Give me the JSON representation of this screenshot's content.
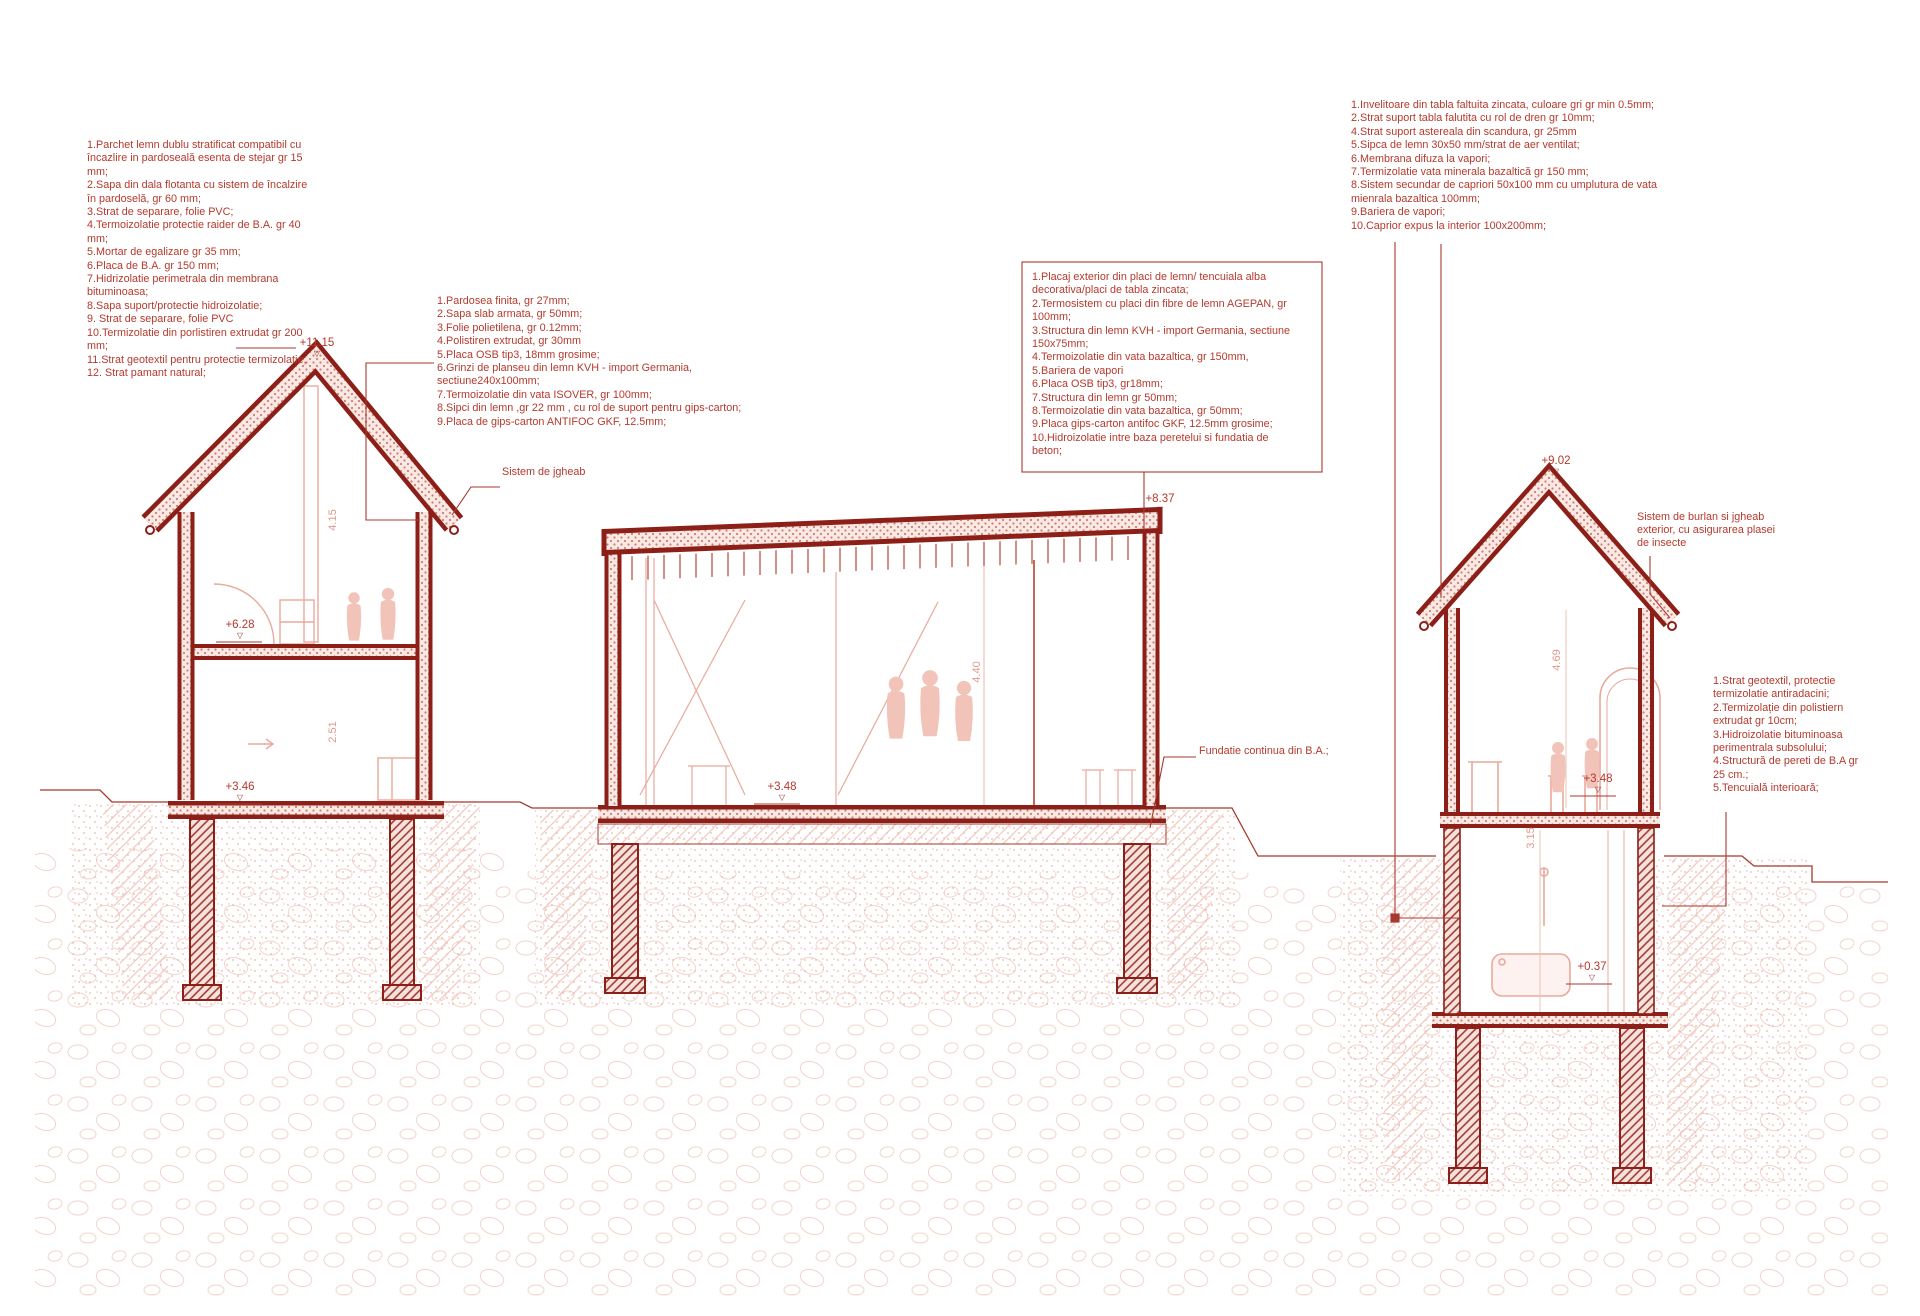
{
  "palette": {
    "structure_dark": "#8c1f17",
    "line_medium": "#a8382d",
    "annotation_red": "#b43a2e",
    "interior_pink": "#e9a99c",
    "soil_pink": "#f2d4cc"
  },
  "annotations": {
    "ground_floor_buildup": {
      "items": [
        "1.Parchet lemn dublu stratificat compatibil cu încazlire in pardoseală esenta de stejar gr 15 mm;",
        "2.Sapa din dala flotanta cu sistem de încalzire în pardoselă, gr 60 mm;",
        "3.Strat de separare, folie PVC;",
        "4.Termoizolatie protectie raider de B.A. gr 40 mm;",
        "5.Mortar de egalizare gr 35 mm;",
        "6.Placa de B.A. gr 150 mm;",
        "7.Hidrizolatie perimetrala din membrana bituminoasa;",
        "8.Sapa suport/protectie hidroizolatie;",
        "9. Strat de separare, folie PVC",
        "10.Termizolatie din porlistiren extrudat gr 200 mm;",
        "11.Strat geotextil pentru protectie termizolatie;",
        "12. Strat pamant natural;"
      ]
    },
    "intermediate_floor_buildup": {
      "items": [
        "1.Pardosea finita, gr 27mm;",
        "2.Sapa slab armata, gr 50mm;",
        "3.Folie polietilena, gr 0.12mm;",
        "4.Polistiren extrudat, gr 30mm",
        "5.Placa OSB tip3, 18mm grosime;",
        "6.Grinzi de planseu din lemn KVH - import Germania, sectiune240x100mm;",
        "7.Termoizolatie din vata ISOVER, gr 100mm;",
        "8.Sipci din lemn ,gr 22 mm , cu rol de suport pentru gips-carton;",
        "9.Placa de gips-carton ANTIFOC GKF, 12.5mm;"
      ]
    },
    "roof_buildup": {
      "items": [
        "1.Invelitoare din tabla faltuita zincata, culoare gri gr min 0.5mm;",
        "2.Strat suport tabla falutita cu rol de dren gr 10mm;",
        "4.Strat suport astereala din scandura, gr 25mm",
        "5.Sipca de lemn 30x50 mm/strat de aer ventilat;",
        "6.Membrana difuza la vapori;",
        "7.Termizolatie vata minerala bazaltică gr 150 mm;",
        "8.Sistem secundar de capriori 50x100 mm cu umplutura de vata mienrala bazaltica 100mm;",
        "9.Bariera de vapori;",
        "10.Caprior expus la interior 100x200mm;"
      ]
    },
    "exterior_wall_buildup": {
      "items": [
        "1.Placaj exterior din placi de lemn/ tencuiala alba decorativa/placi de tabla zincata;",
        "2.Termosistem cu placi din fibre de lemn AGEPAN, gr 100mm;",
        "3.Structura din lemn KVH - import Germania, sectiune 150x75mm;",
        "4.Termoizolatie din vata bazaltica, gr 150mm,",
        "5.Bariera de vapori",
        "6.Placa OSB tip3, gr18mm;",
        "7.Structura din lemn gr 50mm;",
        "8.Termoizolatie din vata bazaltica, gr 50mm;",
        "9.Placa gips-carton antifoc GKF, 12.5mm grosime;",
        "10.Hidroizolatie intre baza peretelui si fundatia de beton;"
      ]
    },
    "basement_wall_buildup": {
      "items": [
        "1.Strat geotextil, protectie termizolatie antiradacini;",
        "2.Termizolație din polistiern extrudat gr 10cm;",
        "3.Hidroizolatie bituminoasa perimentrala subsolului;",
        "4.Structură de pereti de  B.A gr 25 cm.;",
        "5.Tencuială interioară;"
      ]
    }
  },
  "labels": {
    "gutter": "Sistem de jgheab",
    "foundation": "Fundatie continua din B.A.;",
    "downspout": "Sistem de burlan si jgheab exterior, cu asigurarea plasei de insecte"
  },
  "elevations": {
    "left_ridge": "+11.15",
    "left_mid_floor": "+6.28",
    "left_ground": "+3.46",
    "middle_roof": "+8.37",
    "middle_floor": "+3.48",
    "right_ridge": "+9.02",
    "right_floor": "+3.48",
    "right_basement": "+0.37"
  },
  "dimensions": {
    "left_upper": "4.15",
    "left_lower": "2.51",
    "middle_hall": "4.40",
    "right_upper": "4.69",
    "right_basement": "3.15"
  },
  "marker_glyph": "▽"
}
